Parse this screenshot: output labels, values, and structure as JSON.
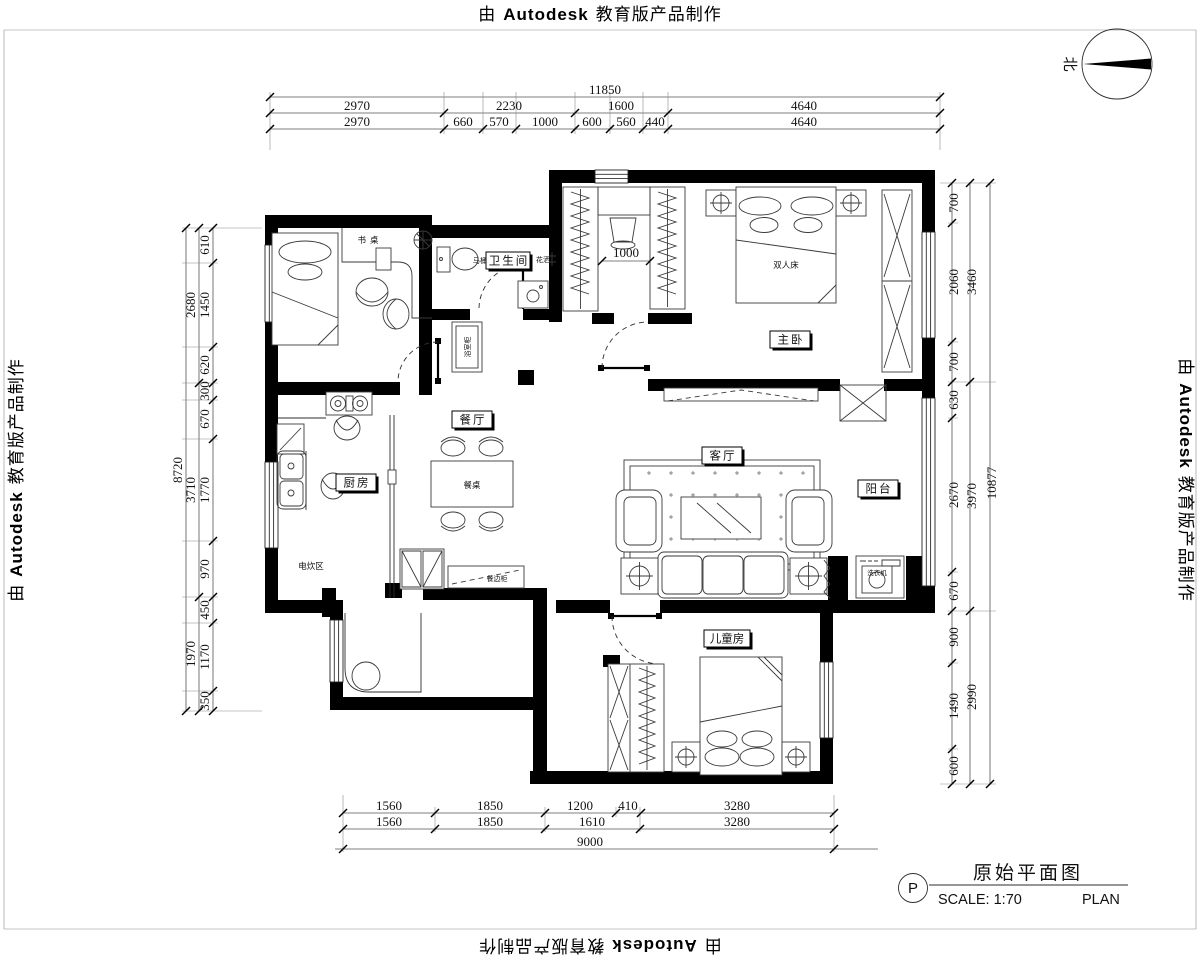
{
  "stamp": {
    "prefix": "由",
    "brand": "Autodesk",
    "suffix": "教育版产品制作"
  },
  "north_label": "北",
  "title_block": {
    "symbol": "P",
    "title": "原始平面图",
    "scale": "SCALE: 1:70",
    "type": "PLAN"
  },
  "rooms": {
    "master": "主卧",
    "kids": "儿童房",
    "living": "客厅",
    "dining": "餐厅",
    "kitchen": "厨房",
    "bathroom": "卫生间",
    "balcony": "阳台"
  },
  "furniture": {
    "desk": "书桌",
    "double_bed": "双人床",
    "toilet": "马桶",
    "shower": "花洒",
    "vanity": "浴室柜",
    "dining_table": "餐桌",
    "sideboard": "餐边柜",
    "cooking_area": "电炊区",
    "washer": "洗衣机"
  },
  "dims": {
    "top_total": "11850",
    "top_row1": [
      "2970",
      "2230",
      "1600",
      "4640"
    ],
    "top_row2": [
      "2970",
      "660",
      "570",
      "1000",
      "600",
      "560",
      "440",
      "4640"
    ],
    "bottom_row1": [
      "1560",
      "1850",
      "1200",
      "410",
      "3280"
    ],
    "bottom_row2": [
      "1560",
      "1850",
      "1610",
      "3280"
    ],
    "bottom_total": "9000",
    "left_inner": [
      "610",
      "1450",
      "620",
      "300",
      "670",
      "1770",
      "970",
      "450",
      "1170",
      "350"
    ],
    "left_mid": [
      "2680",
      "3710",
      "1970"
    ],
    "left_total": "8720",
    "right_inner": [
      "700",
      "2060",
      "700",
      "630",
      "2670",
      "670",
      "900",
      "1490",
      "600"
    ],
    "right_mid": [
      "3460",
      "3970",
      "2990"
    ],
    "right_total": "10877",
    "closet": "1000"
  },
  "colors": {
    "wall": "#000000",
    "background": "#ffffff",
    "line": "#2e2e2e"
  }
}
